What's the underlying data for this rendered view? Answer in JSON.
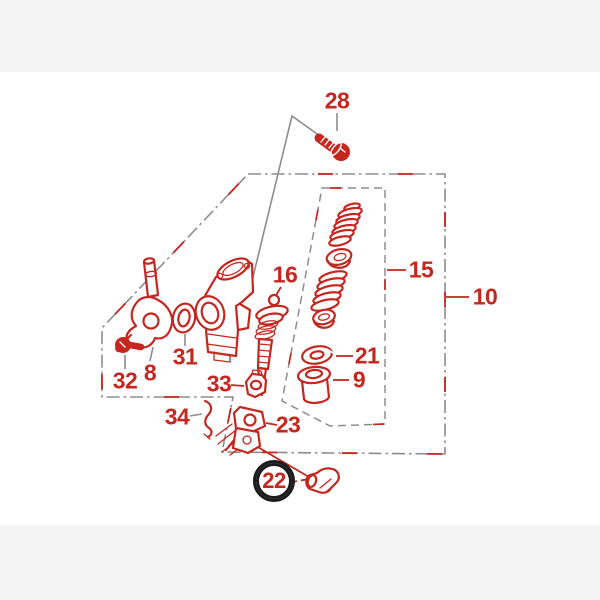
{
  "figure": {
    "kind": "exploded-parts-diagram",
    "colors": {
      "part_red": "#c5271f",
      "line_gray": "#8d8d8d",
      "highlight_black": "#1b1b1b",
      "margin_band": "#f3f3f3",
      "canvas": "#ffffff"
    }
  },
  "callouts": [
    {
      "label": "28",
      "x": 337,
      "y": 101,
      "circled": false
    },
    {
      "label": "16",
      "x": 285,
      "y": 275,
      "circled": false
    },
    {
      "label": "15",
      "x": 421,
      "y": 270,
      "circled": false
    },
    {
      "label": "10",
      "x": 485,
      "y": 297,
      "circled": false
    },
    {
      "label": "21",
      "x": 367,
      "y": 356,
      "circled": false
    },
    {
      "label": "9",
      "x": 359,
      "y": 380,
      "circled": false
    },
    {
      "label": "31",
      "x": 185,
      "y": 357,
      "circled": false
    },
    {
      "label": "8",
      "x": 150,
      "y": 373,
      "circled": false
    },
    {
      "label": "32",
      "x": 125,
      "y": 381,
      "circled": false
    },
    {
      "label": "33",
      "x": 219,
      "y": 384,
      "circled": false
    },
    {
      "label": "34",
      "x": 177,
      "y": 417,
      "circled": false
    },
    {
      "label": "23",
      "x": 288,
      "y": 425,
      "circled": false
    },
    {
      "label": "22",
      "x": 274,
      "y": 481,
      "circled": true
    }
  ],
  "highlighted_callout": "22"
}
